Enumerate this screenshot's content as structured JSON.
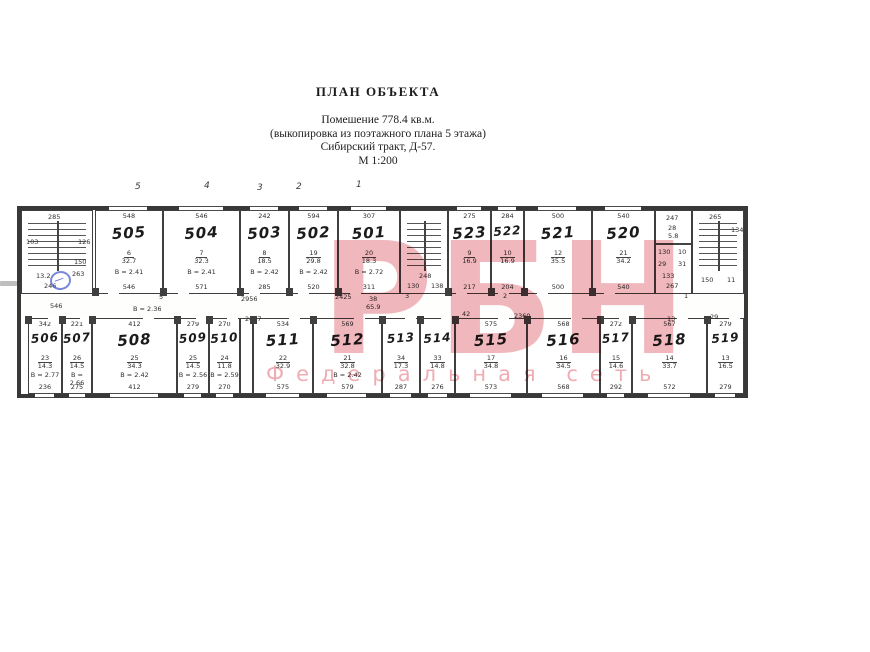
{
  "header": {
    "title": "ПЛАН ОБЪЕКТА",
    "lines": [
      "Помешение 778.4 кв.м.",
      "(выкопировка из поэтажного плана 5 этажа)",
      "Сибирский тракт, Д-57.",
      "М 1:200"
    ]
  },
  "watermark": {
    "title": "РБН",
    "subtitle": "Федеральная сеть",
    "color": "#e06a75"
  },
  "axis_labels": [
    {
      "text": "5",
      "x": 135,
      "y": 182
    },
    {
      "text": "4",
      "x": 204,
      "y": 181
    },
    {
      "text": "3",
      "x": 257,
      "y": 183
    },
    {
      "text": "2",
      "x": 296,
      "y": 182
    },
    {
      "text": "1",
      "x": 356,
      "y": 180
    }
  ],
  "plan": {
    "rooms_top": [
      {
        "num": "505",
        "top": "548",
        "no": "6",
        "area": "32.7",
        "height": "В = 2.41",
        "bottom": "546",
        "x": 74,
        "w": 68
      },
      {
        "num": "504",
        "top": "546",
        "no": "7",
        "area": "32.3",
        "height": "В = 2.41",
        "bottom": "571",
        "x": 142,
        "w": 77
      },
      {
        "num": "503",
        "top": "242",
        "no": "8",
        "area": "18.5",
        "height": "В = 2.42",
        "bottom": "285",
        "x": 219,
        "w": 49
      },
      {
        "num": "502",
        "top": "594",
        "no": "19",
        "area": "29.8",
        "height": "В = 2.42",
        "bottom": "520",
        "x": 268,
        "w": 49
      },
      {
        "num": "501",
        "top": "307",
        "no": "20",
        "area": "18.3",
        "height": "В = 2.72",
        "bottom": "311",
        "x": 317,
        "w": 62
      },
      {
        "num": "523",
        "top": "275",
        "no": "9",
        "area": "16.9",
        "height": "",
        "bottom": "217",
        "x": 427,
        "w": 43
      },
      {
        "num": "522",
        "top": "284",
        "no": "10",
        "area": "16.9",
        "height": "",
        "bottom": "204",
        "x": 470,
        "w": 33
      },
      {
        "num": "521",
        "top": "500",
        "no": "12",
        "area": "35.5",
        "height": "",
        "bottom": "500",
        "x": 503,
        "w": 68
      },
      {
        "num": "520",
        "top": "540",
        "no": "21",
        "area": "34.2",
        "height": "",
        "bottom": "540",
        "x": 571,
        "w": 63
      }
    ],
    "rooms_bottom": [
      {
        "num": "506",
        "top": "342",
        "no": "23",
        "area": "14.3",
        "height": "В = 2.77",
        "bottom": "236",
        "x": 7,
        "w": 34
      },
      {
        "num": "507",
        "top": "221",
        "no": "26",
        "area": "14.5",
        "height": "В = 2.66",
        "bottom": "275",
        "x": 41,
        "w": 30
      },
      {
        "num": "508",
        "top": "412",
        "no": "25",
        "area": "34.3",
        "height": "В = 2.42",
        "bottom": "412",
        "x": 71,
        "w": 85
      },
      {
        "num": "509",
        "top": "279",
        "no": "25",
        "area": "14.5",
        "height": "В = 2.56",
        "bottom": "279",
        "x": 156,
        "w": 32
      },
      {
        "num": "510",
        "top": "270",
        "no": "24",
        "area": "11.8",
        "height": "В = 2.59",
        "bottom": "270",
        "x": 188,
        "w": 31
      },
      {
        "num": "511",
        "top": "534",
        "no": "22",
        "area": "32.9",
        "height": "",
        "bottom": "575",
        "x": 232,
        "w": 60
      },
      {
        "num": "512",
        "top": "569",
        "no": "21",
        "area": "32.8",
        "height": "В = 2.42",
        "bottom": "579",
        "x": 292,
        "w": 69
      },
      {
        "num": "513",
        "top": "",
        "no": "34",
        "area": "17.3",
        "height": "",
        "bottom": "287",
        "x": 361,
        "w": 38
      },
      {
        "num": "514",
        "top": "",
        "no": "33",
        "area": "14.8",
        "height": "",
        "bottom": "276",
        "x": 399,
        "w": 35
      },
      {
        "num": "515",
        "top": "575",
        "no": "17",
        "area": "34.8",
        "height": "",
        "bottom": "573",
        "x": 434,
        "w": 72
      },
      {
        "num": "516",
        "top": "568",
        "no": "16",
        "area": "34.5",
        "height": "",
        "bottom": "568",
        "x": 506,
        "w": 73
      },
      {
        "num": "517",
        "top": "272",
        "no": "15",
        "area": "14.6",
        "height": "",
        "bottom": "292",
        "x": 579,
        "w": 32
      },
      {
        "num": "518",
        "top": "567",
        "no": "14",
        "area": "33.7",
        "height": "",
        "bottom": "572",
        "x": 611,
        "w": 75
      },
      {
        "num": "519",
        "top": "279",
        "no": "13",
        "area": "16.5",
        "height": "",
        "bottom": "279",
        "x": 686,
        "w": 37
      }
    ],
    "stairwells": [
      {
        "name": "stair-left",
        "x": 0,
        "w": 72,
        "labels": [
          {
            "t": "285",
            "lx": 26,
            "ly": 3
          },
          {
            "t": "103",
            "lx": 4,
            "ly": 28
          },
          {
            "t": "126",
            "lx": 56,
            "ly": 28
          },
          {
            "t": "150",
            "lx": 52,
            "ly": 48
          },
          {
            "t": "263",
            "lx": 50,
            "ly": 60
          },
          {
            "t": "13.2",
            "lx": 14,
            "ly": 62
          },
          {
            "t": "246",
            "lx": 22,
            "ly": 72
          },
          {
            "t": "546",
            "lx": 28,
            "ly": 92
          }
        ]
      },
      {
        "name": "stair-central",
        "x": 379,
        "w": 48,
        "labels": [
          {
            "t": "248",
            "lx": 18,
            "ly": 62
          },
          {
            "t": "130",
            "lx": 6,
            "ly": 72
          },
          {
            "t": "138",
            "lx": 30,
            "ly": 72
          }
        ]
      },
      {
        "name": "stair-right",
        "x": 671,
        "w": 52,
        "labels": [
          {
            "t": "265",
            "lx": 16,
            "ly": 3
          },
          {
            "t": "134",
            "lx": 38,
            "ly": 16
          },
          {
            "t": "150",
            "lx": 8,
            "ly": 66
          },
          {
            "t": "11",
            "lx": 34,
            "ly": 66
          }
        ]
      }
    ],
    "utility_block": {
      "x": 634,
      "w": 37,
      "labels": [
        {
          "t": "247",
          "lx": 10,
          "ly": 4
        },
        {
          "t": "28",
          "lx": 12,
          "ly": 14
        },
        {
          "t": "5.8",
          "lx": 12,
          "ly": 22
        },
        {
          "t": "130",
          "lx": 2,
          "ly": 38
        },
        {
          "t": "10",
          "lx": 22,
          "ly": 38
        },
        {
          "t": "29",
          "lx": 2,
          "ly": 50
        },
        {
          "t": "31",
          "lx": 22,
          "ly": 50
        },
        {
          "t": "133",
          "lx": 6,
          "ly": 62
        },
        {
          "t": "267",
          "lx": 10,
          "ly": 72
        }
      ]
    },
    "corridor_labels": [
      {
        "t": "В = 2.36",
        "x": 112,
        "y": 96
      },
      {
        "t": "2956",
        "x": 220,
        "y": 86
      },
      {
        "t": "2457",
        "x": 224,
        "y": 106
      },
      {
        "t": "2425",
        "x": 314,
        "y": 84
      },
      {
        "t": "38",
        "x": 348,
        "y": 86
      },
      {
        "t": "65.9",
        "x": 345,
        "y": 94
      },
      {
        "t": "42",
        "x": 441,
        "y": 101
      },
      {
        "t": "2360",
        "x": 493,
        "y": 103
      },
      {
        "t": "13",
        "x": 646,
        "y": 106
      },
      {
        "t": "29",
        "x": 689,
        "y": 104
      },
      {
        "t": "5",
        "x": 138,
        "y": 84
      },
      {
        "t": "3",
        "x": 384,
        "y": 83
      },
      {
        "t": "2",
        "x": 482,
        "y": 83
      },
      {
        "t": "1",
        "x": 663,
        "y": 83
      }
    ]
  }
}
